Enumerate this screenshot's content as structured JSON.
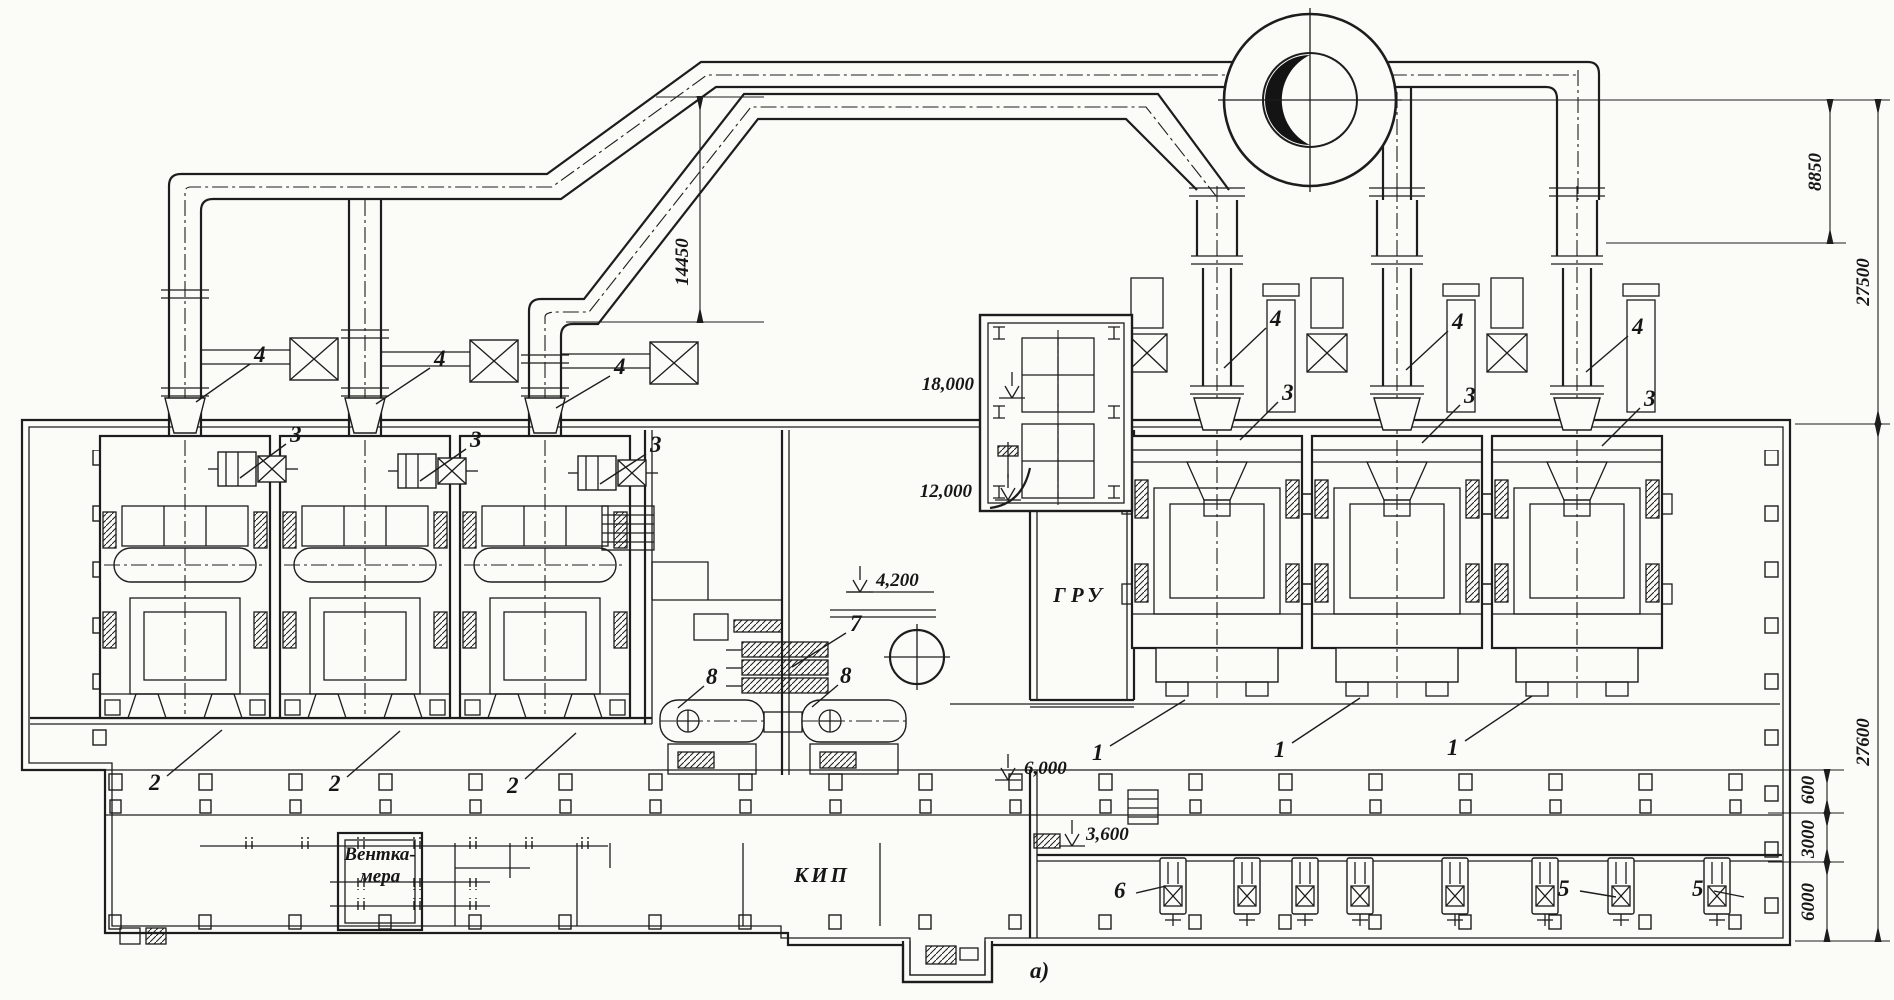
{
  "drawing": {
    "figure_label": "а)",
    "rooms": {
      "gru": "ГРУ",
      "kip": "КИП",
      "vent_line1": "Вентка-",
      "vent_line2": "мера"
    },
    "elevations": {
      "e18": "18,000",
      "e12": "12,000",
      "e4_2": "4,200",
      "e6": "6,000",
      "e3_6": "3,600"
    },
    "dimensions": {
      "d14450": "14450",
      "d8850": "8850",
      "d27500": "27500",
      "d27600": "27600",
      "d600": "600",
      "d3000": "3000",
      "d6000": "6000"
    },
    "callouts": {
      "boiler_right": "1",
      "boiler_left": "2",
      "fan": "3",
      "exhauster": "4",
      "pump_right": "5",
      "pump_feed": "6",
      "heater": "7",
      "tank": "8"
    }
  }
}
